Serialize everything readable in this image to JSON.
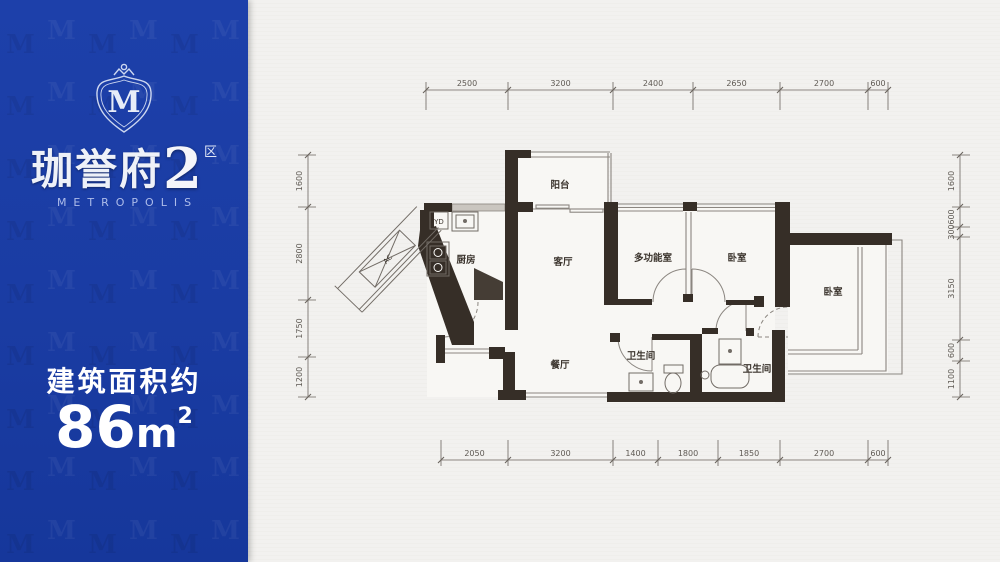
{
  "panel": {
    "logo": {
      "letter": "M"
    },
    "watermark": {
      "letter": "M"
    },
    "title": {
      "name": "珈誉府",
      "number": "2",
      "superscript": "区"
    },
    "subtitle": "METROPOLIS",
    "area": {
      "label": "建筑面积约",
      "value": "86",
      "unit": "m",
      "exponent": "2"
    },
    "colors": {
      "background": "#1a3ca3",
      "text": "#ffffff"
    }
  },
  "floorplan": {
    "rooms": [
      {
        "label": "阳台"
      },
      {
        "label": "厨房"
      },
      {
        "label": "客厅"
      },
      {
        "label": "多功能室"
      },
      {
        "label": "卧室"
      },
      {
        "label": "卧室"
      },
      {
        "label": "餐厅"
      },
      {
        "label": "卫生间"
      },
      {
        "label": "卫生间"
      }
    ],
    "annotations": {
      "laundry": "YD",
      "air_conditioner": "AC"
    },
    "dimensions": {
      "top": [
        "2500",
        "3200",
        "2400",
        "2650",
        "2700",
        "600"
      ],
      "bottom": [
        "2050",
        "3200",
        "1400",
        "1800",
        "1850",
        "2700",
        "600"
      ],
      "left": [
        "1600",
        "2800",
        "1750",
        "1200"
      ],
      "right": [
        "1600",
        "600",
        "300",
        "3150",
        "600",
        "1100"
      ]
    },
    "colors": {
      "wall": "#362e27",
      "line": "#8b8680",
      "dim_text": "#5f5a54"
    }
  }
}
